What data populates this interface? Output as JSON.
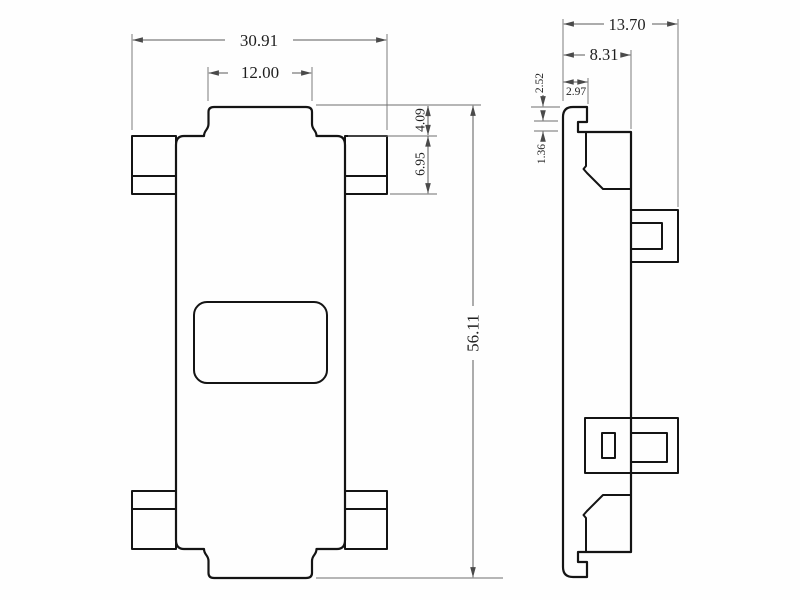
{
  "drawing": {
    "type": "technical-drawing",
    "views": [
      "front",
      "side"
    ],
    "front": {
      "dims": {
        "overall_width": "30.91",
        "top_tab_width": "12.00",
        "tab_height": "4.09",
        "mount_ear_height": "6.95",
        "overall_height": "56.11"
      }
    },
    "side": {
      "dims": {
        "overall_depth": "13.70",
        "body_depth": "8.31",
        "front_flange_depth": "2.97",
        "top_step_depth": "2.52",
        "latch_notch_height": "1.36"
      }
    },
    "colors": {
      "outline": "#141414",
      "dimension_line": "#5a5a5a",
      "text": "#1f1f1f",
      "background": "#fefefe"
    }
  }
}
